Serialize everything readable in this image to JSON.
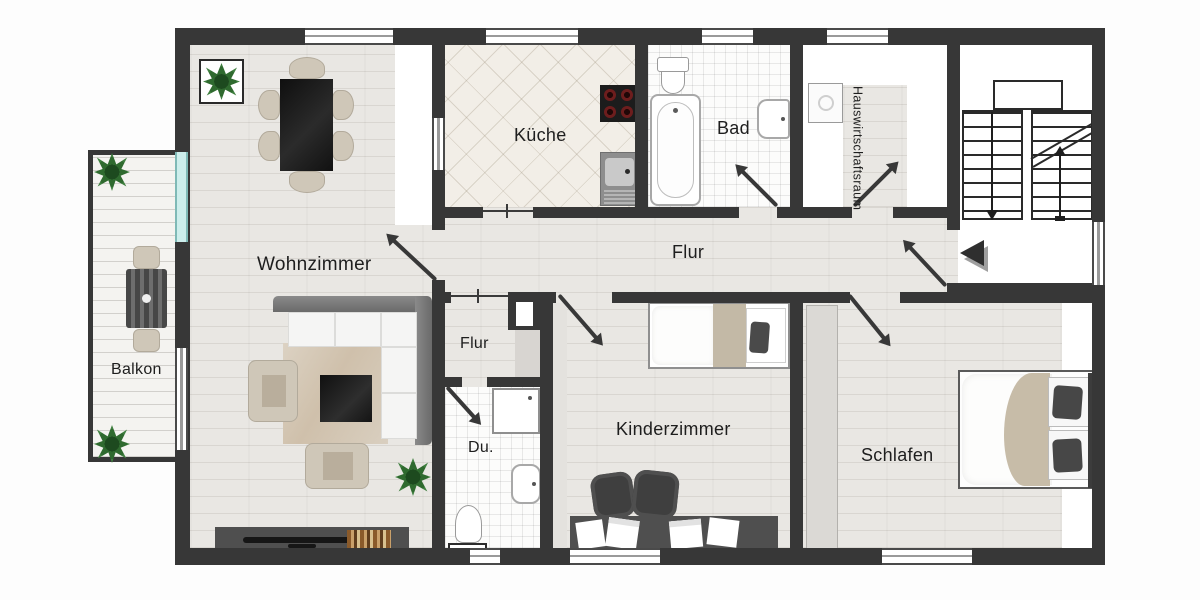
{
  "plan": {
    "rooms": {
      "wohnzimmer": "Wohnzimmer",
      "kueche": "Küche",
      "bad": "Bad",
      "hauswirtschaftsraum": "Hauswirtschaftsraum",
      "flur": "Flur",
      "flur_klein": "Flur",
      "dusche": "Du.",
      "kinderzimmer": "Kinderzimmer",
      "schlafen": "Schlafen",
      "balkon": "Balkon"
    },
    "colors": {
      "wall": "#373737",
      "floor_wood": "#e9e7e3",
      "kitchen_tile": "#f2eee7",
      "bath_tile": "#fbfbfa",
      "balcony_glass_door": "#b7e4e2",
      "plant_green": "#2f6a2f",
      "furniture_dark": "#4a4a4a",
      "furniture_beige": "#cfc7b8",
      "bed_blanket": "#c7bca8",
      "label_text": "#1e1e1e"
    }
  }
}
